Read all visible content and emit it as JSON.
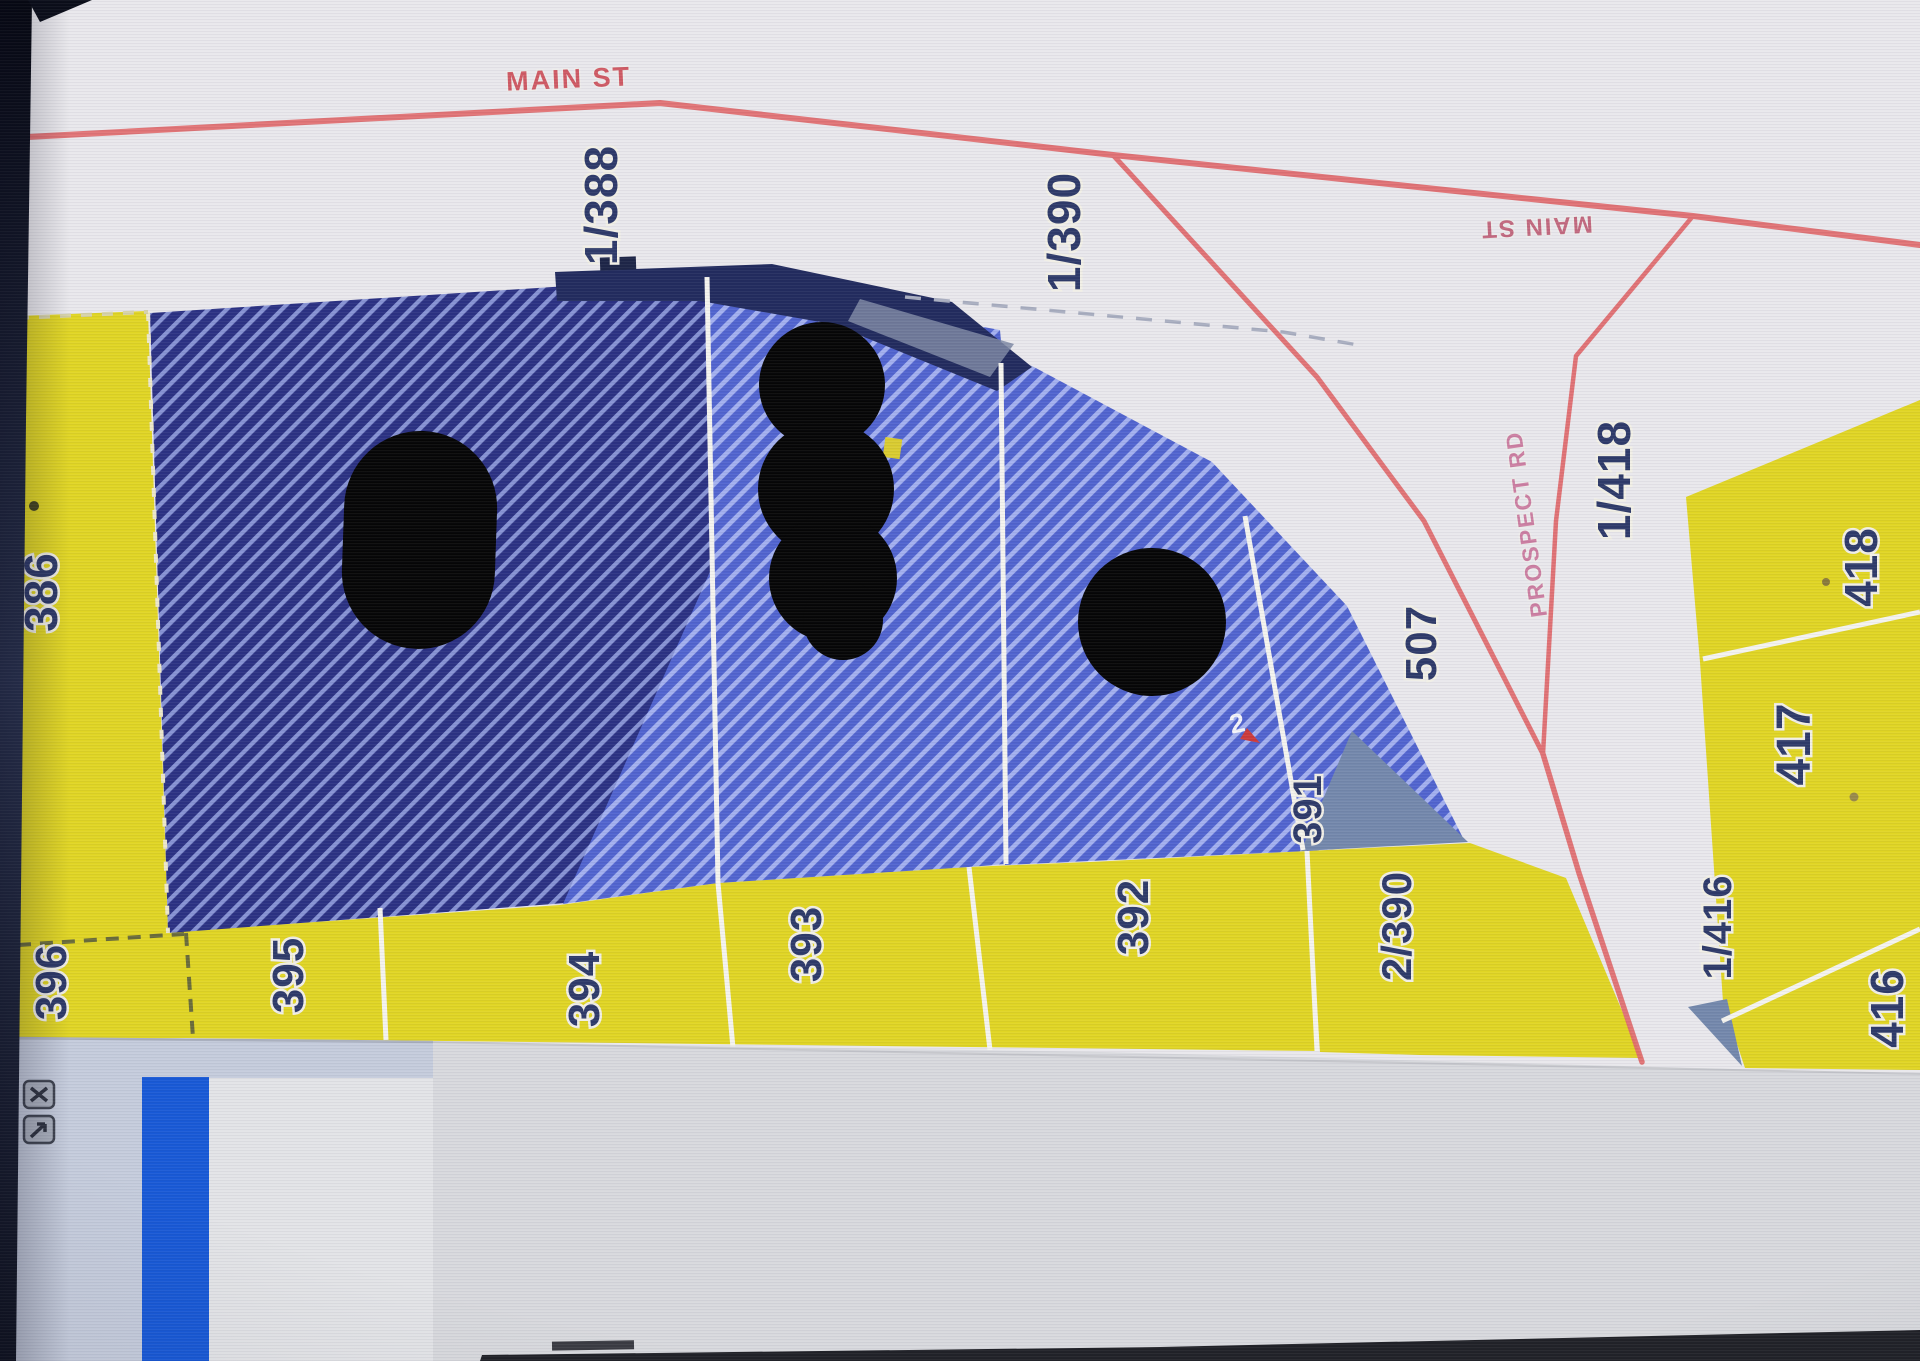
{
  "map": {
    "roads": {
      "main_st_top": "MAIN ST",
      "main_st_right": "MAIN ST",
      "prospect_rd": "PROSPECT RD"
    },
    "parcels": {
      "p1_388": "1/388",
      "p1_390": "1/390",
      "p386": "386",
      "p396": "396",
      "p395": "395",
      "p394": "394",
      "p393": "393",
      "p392": "392",
      "p391": "391",
      "p2_390": "2/390",
      "p507": "507",
      "p1_418": "1/418",
      "p417": "417",
      "p418": "418",
      "p416": "416",
      "p1_416": "1/416"
    },
    "marker_label": "2",
    "colors": {
      "paper": "#e9e8ec",
      "parcel_yellow": "#e0d524",
      "parcel_blue_dark": "#2b3183",
      "hatch_dark_line": "#8793d4",
      "parcel_blue_light": "#5164cf",
      "hatch_light_line": "#a3b0ef",
      "roof_band": "#222b5e",
      "gray_parcel": "#7488ac",
      "road_red": "#e0696b",
      "label_navy": "#2e3a69",
      "road_label_red": "#cf5a64",
      "road_label_pink": "#cc7fa2",
      "selection_blue": "#1859d6",
      "panel_gray": "#c5ccdc"
    }
  },
  "taskbar": {
    "icons": [
      {
        "name": "overlay-close-icon"
      },
      {
        "name": "overlay-export-icon"
      }
    ]
  }
}
